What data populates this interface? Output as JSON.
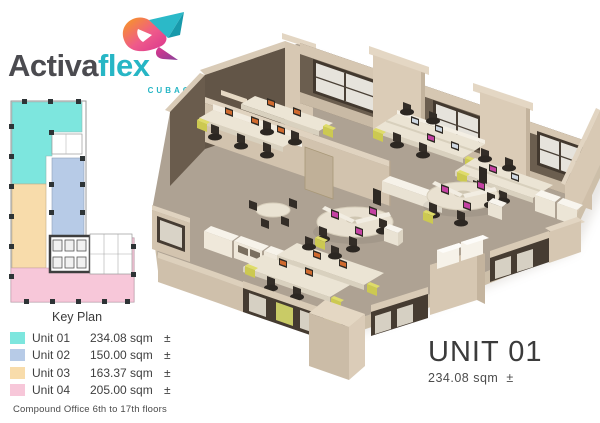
{
  "logo": {
    "brand_part1": "Activa",
    "brand_part2": "flex",
    "subtitle": "CUBAO",
    "mark_colors": {
      "orange": "#f89c1c",
      "magenta": "#e0368c",
      "purple": "#8a4099",
      "teal": "#2bb9c8"
    }
  },
  "key_plan": {
    "title": "Key Plan",
    "note": "Compound Office 6th to 17th floors",
    "units": [
      {
        "label": "Unit 01",
        "area": "234.08 sqm",
        "pm": "±",
        "color": "#7de6de"
      },
      {
        "label": "Unit 02",
        "area": "150.00 sqm",
        "pm": "±",
        "color": "#b7cbe7"
      },
      {
        "label": "Unit 03",
        "area": "163.37 sqm",
        "pm": "±",
        "color": "#f8dcab"
      },
      {
        "label": "Unit 04",
        "area": "205.00 sqm",
        "pm": "±",
        "color": "#f7c7d9"
      }
    ]
  },
  "featured_unit": {
    "name": "UNIT 01",
    "area": "234.08 sqm",
    "pm": "±"
  },
  "palette": {
    "floor": "#aea293",
    "wall_light": "#d2c3ae",
    "wall_dark": "#625547",
    "window_frame": "#463c32",
    "glass": "#e6e3dc",
    "desk": "#ebe4d4",
    "chair": "#332d27",
    "accent_yellow": "#ccc951",
    "screen_magenta": "#c441a3",
    "screen_orange": "#d06a2e"
  }
}
